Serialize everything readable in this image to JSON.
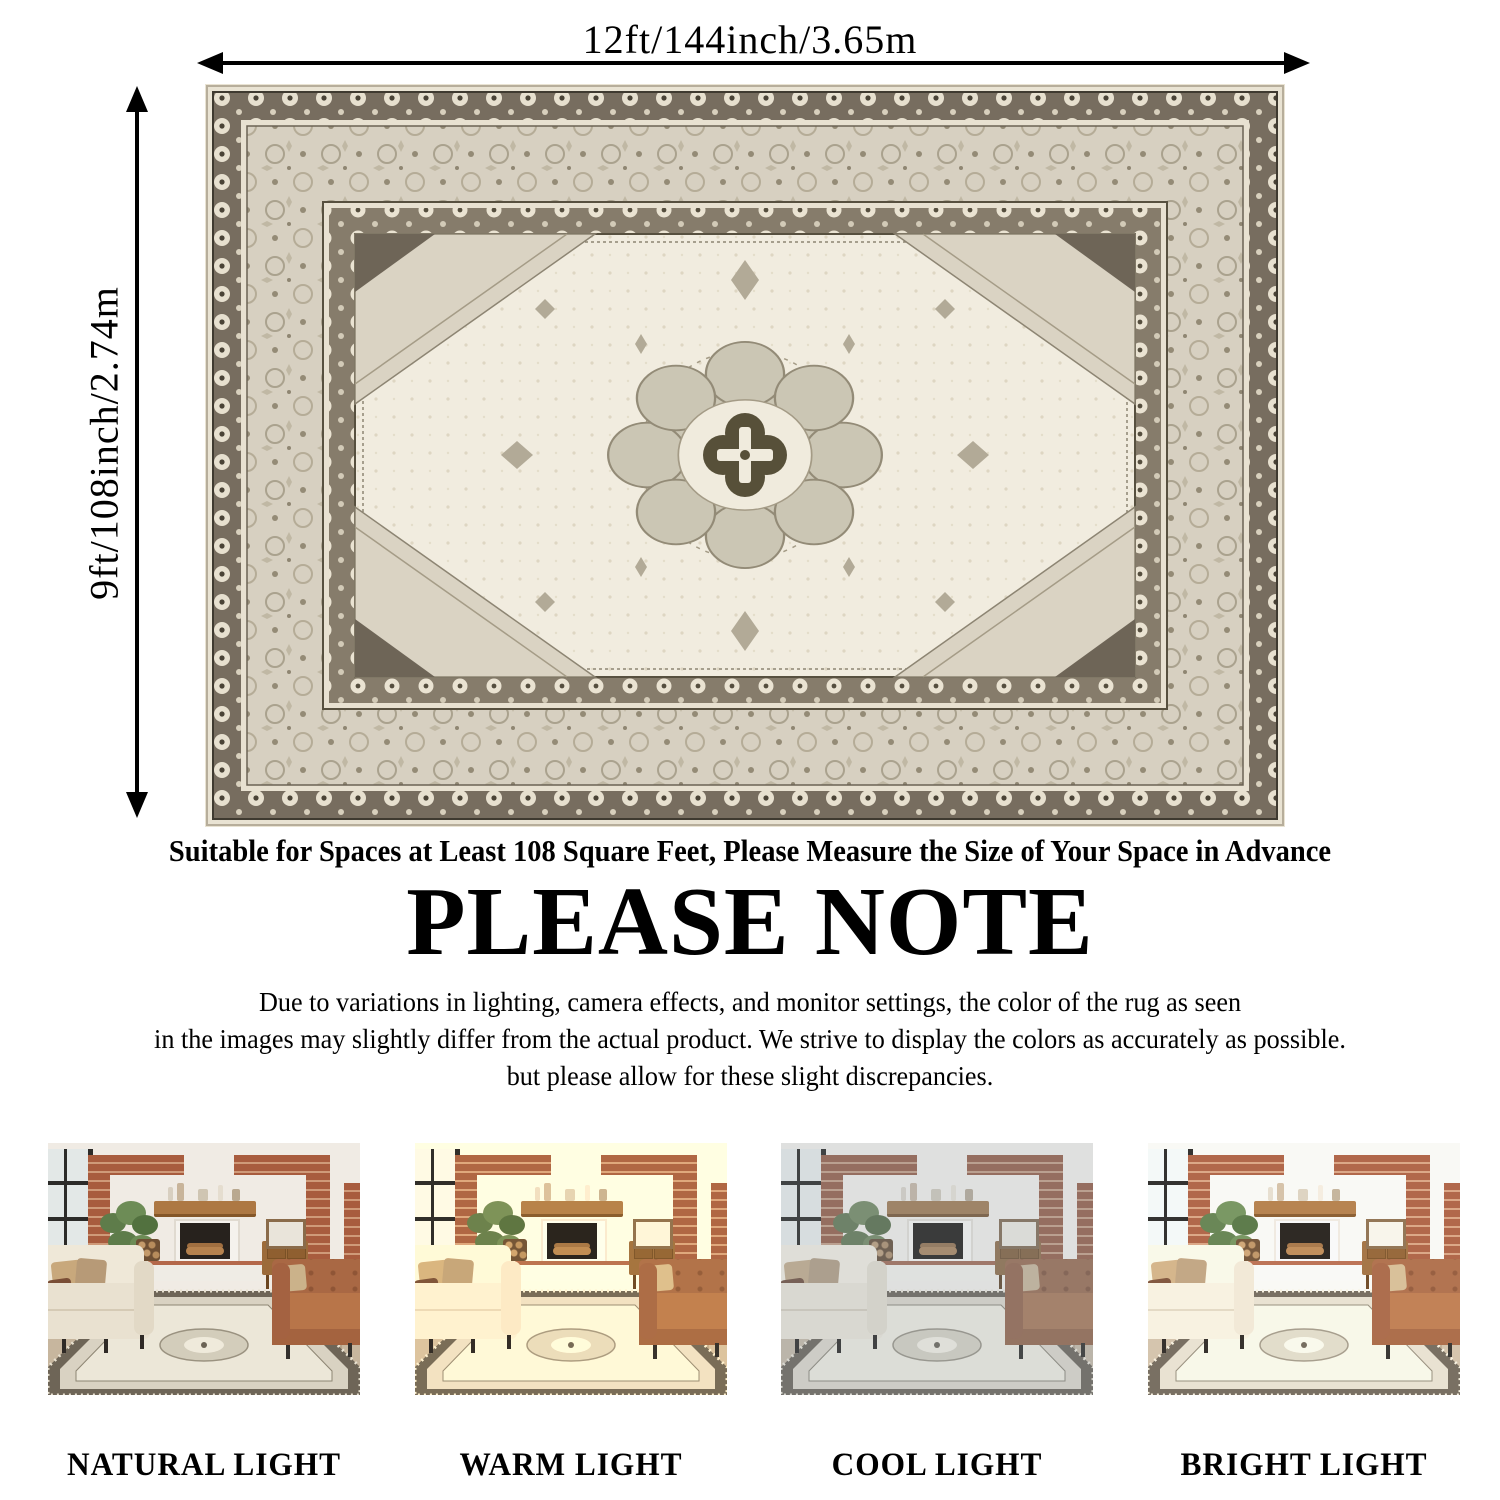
{
  "page": {
    "background": "#ffffff"
  },
  "size_diagram": {
    "width_label": "12ft/144inch/3.65m",
    "height_label": "9ft/108inch/2.74m"
  },
  "notes": {
    "suitable_line": "Suitable for Spaces at Least 108 Square Feet, Please Measure the Size of Your Space in Advance",
    "heading": "PLEASE NOTE",
    "body_lines": [
      "Due to variations in lighting, camera effects, and monitor settings, the color of the rug as seen",
      "in the images may slightly differ from the actual product. We strive to display the colors as accurately as possible.",
      "but please allow for these slight discrepancies."
    ]
  },
  "lighting_variants": [
    {
      "key": "natural",
      "label": "NATURAL LIGHT"
    },
    {
      "key": "warm",
      "label": "WARM LIGHT"
    },
    {
      "key": "cool",
      "label": "COOL LIGHT"
    },
    {
      "key": "bright",
      "label": "BRIGHT LIGHT"
    }
  ],
  "colors": {
    "annotation_arrow": "#000000",
    "text": "#000000",
    "rug_fringe": "#e9e3d3",
    "rug_border_dark": "#776d5f",
    "rug_border_light": "#d7d0c1",
    "rug_field": "#f1ecdf",
    "rug_medallion": "#cbc6b4",
    "rug_medallion_center": "#575039",
    "photo_wall": "#f0ebe4",
    "photo_brick": "#a85c3e",
    "photo_wood_mantel": "#ad7843",
    "photo_cream_sofa": "#e9e1d0",
    "photo_leather_sofa": "#b87549",
    "photo_plant": "#5e7c4a",
    "photo_floor": "#c7b69e"
  }
}
